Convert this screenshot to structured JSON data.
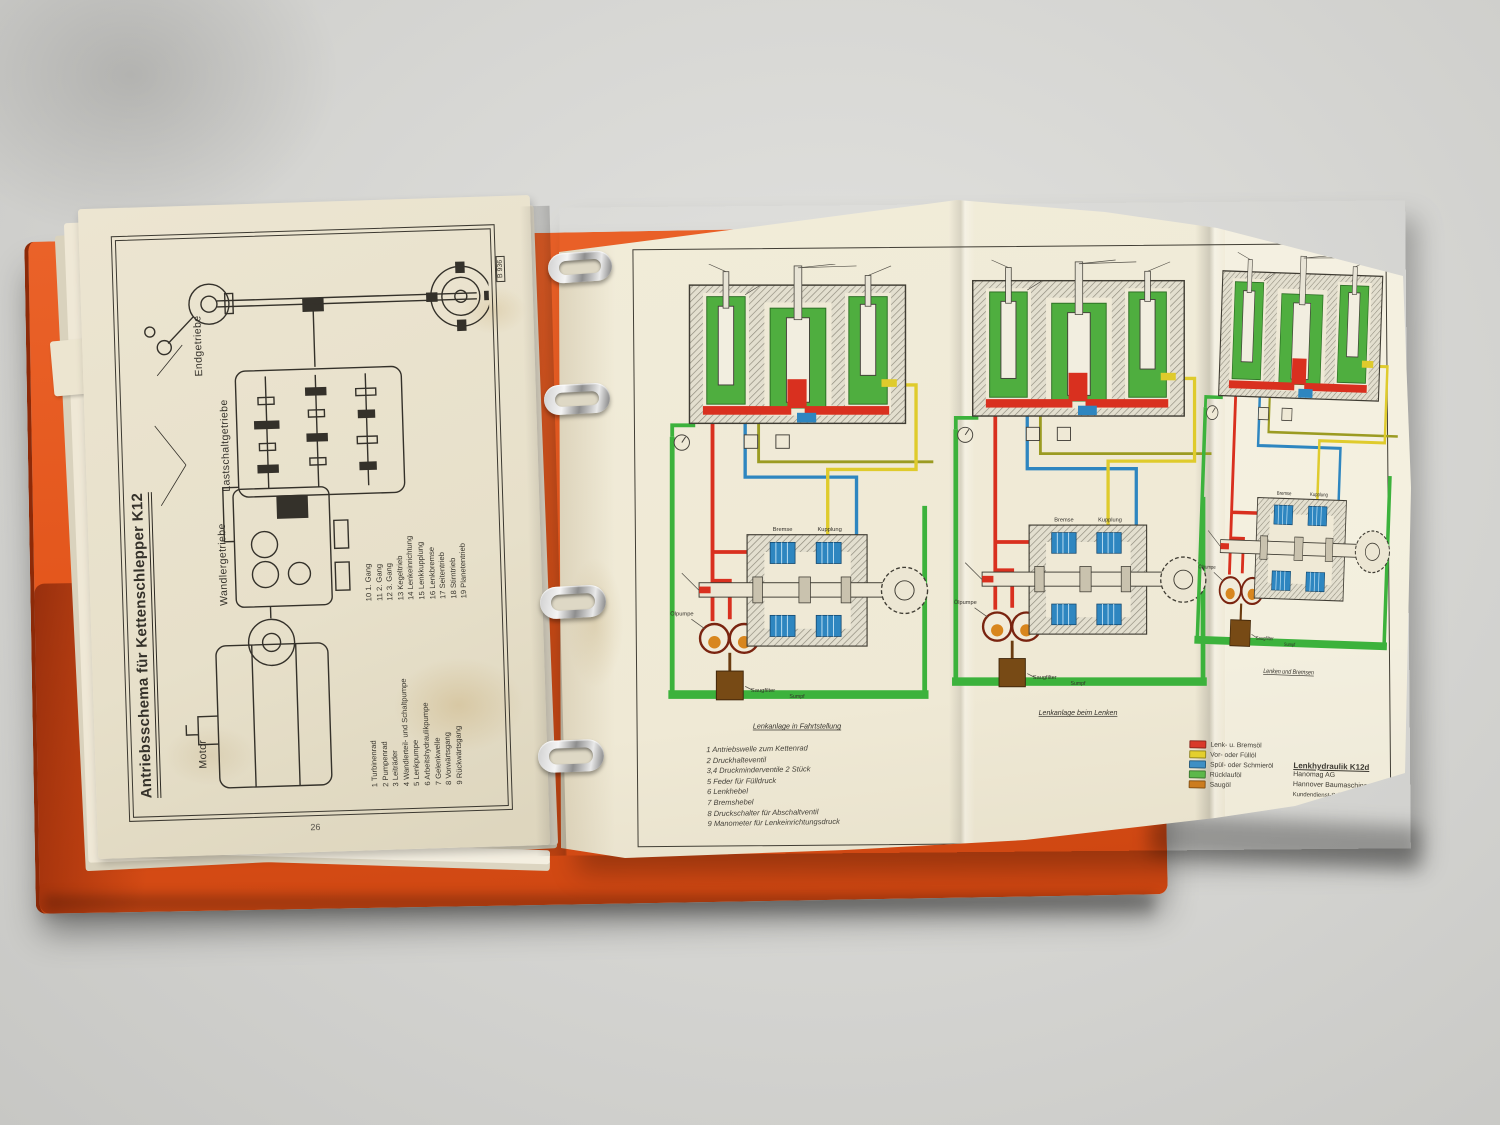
{
  "photo": {
    "description": "Open orange ring binder with Hanomag K12 crawler tractor manual pages",
    "colors": {
      "binder": "#e2571c",
      "page_left": "#e9e2cd",
      "foldout": "#f0ead7",
      "background": "#d7d7d4"
    }
  },
  "left_page": {
    "stamp": "B 936",
    "title": "Antriebsschema für Kettenschlepper K12",
    "section_labels": {
      "motor": "Motor",
      "wandler": "Wandlergetriebe",
      "lastschalt": "Lastschaltgetriebe",
      "end": "Endgetriebe"
    },
    "page_number": "26",
    "legend_col1": [
      "1  Turbinenrad",
      "2  Pumpenrad",
      "3  Leiträder",
      "4  Wandlerteil- und Schaltpumpe",
      "5  Lenkpumpe",
      "6  Arbeitshydraulikpumpe",
      "7  Gelenkwelle",
      "8  Vorwärtsgang",
      "9  Rückwärtsgang"
    ],
    "legend_col2": [
      "10  1. Gang",
      "11  2. Gang",
      "12  3. Gang",
      "13  Kegeltrieb",
      "14  Lenkeinrichtung",
      "15  Lenkkupplung",
      "16  Lenkbremse",
      "17  Seitentrieb",
      "18  Stirntrieb",
      "19  Planetentrieb"
    ]
  },
  "foldout": {
    "diagrams": [
      {
        "caption": "Lenkanlage in Fahrtstellung"
      },
      {
        "caption": "Lenkanlage beim Lenken"
      },
      {
        "caption": "Lenken und Bremsen"
      }
    ],
    "part_labels": {
      "bremse": "Bremse",
      "kupplung": "Kupplung",
      "oelpumpe": "Ölpumpe",
      "saugfilter": "Saugfilter",
      "sumpf": "Sumpf"
    },
    "numbered_legend": [
      "1 Antriebswelle zum Kettenrad",
      "2 Druckhalteventil",
      "3,4 Druckminderventile 2 Stück",
      "5 Feder für Fülldruck",
      "6 Lenkhebel",
      "7 Bremshebel",
      "8 Druckschalter für Abschaltventil",
      "9 Manometer für Lenkeinrichtungsdruck"
    ],
    "color_legend": [
      {
        "color": "#d93a2b",
        "label": "Lenk- u. Bremsöl"
      },
      {
        "color": "#e3cf2e",
        "label": "Vor- oder Füllöl"
      },
      {
        "color": "#3f8fc4",
        "label": "Spül- oder Schmieröl"
      },
      {
        "color": "#5cb84a",
        "label": "Rücklauföl"
      },
      {
        "color": "#cc7c1e",
        "label": "Saugöl"
      }
    ],
    "title_block": {
      "title": "Lenkhydraulik K12d",
      "line1": "Hanomag AG",
      "line2": "Hannover Baumaschinen",
      "line3": "Kundendienst-Schule"
    }
  }
}
